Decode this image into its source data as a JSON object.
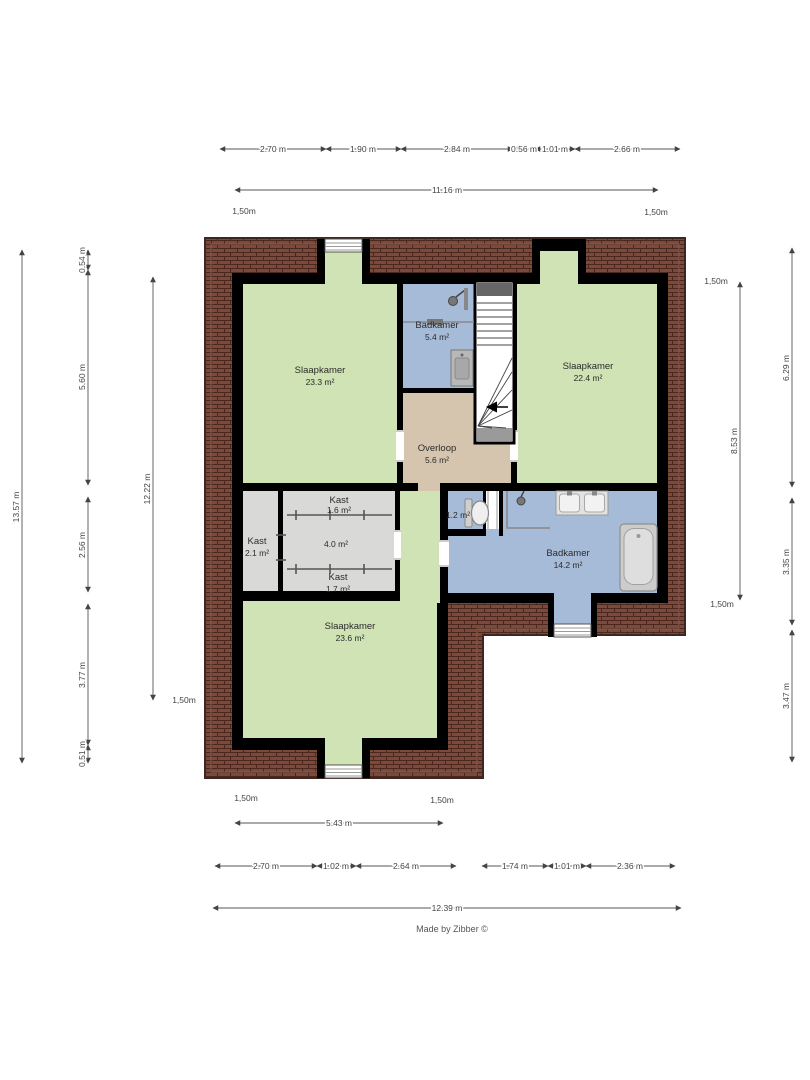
{
  "footer": {
    "credit": "Made by Zibber ©"
  },
  "rooms": {
    "bedroom_top_left": {
      "name": "Slaapkamer",
      "area": "23.3 m²"
    },
    "bathroom_top": {
      "name": "Badkamer",
      "area": "5.4 m²"
    },
    "bedroom_top_right": {
      "name": "Slaapkamer",
      "area": "22.4 m²"
    },
    "landing": {
      "name": "Overloop",
      "area": "5.6 m²"
    },
    "closet_left": {
      "name": "Kast",
      "area": "2.1 m²"
    },
    "closet_top": {
      "name": "Kast",
      "area": "1.6 m²"
    },
    "closet_mid": {
      "area": "4.0 m²"
    },
    "closet_bottom": {
      "name": "Kast",
      "area": "1.7 m²"
    },
    "toilet": {
      "area": "1.2 m²"
    },
    "bathroom_main": {
      "name": "Badkamer",
      "area": "14.2 m²"
    },
    "bedroom_bottom": {
      "name": "Slaapkamer",
      "area": "23.6 m²"
    }
  },
  "dimensions": {
    "marker": "1,50m",
    "top": {
      "segments": [
        "2.70 m",
        "1.90 m",
        "2.84 m",
        "0.56 m",
        "1.01 m",
        "2.66 m"
      ],
      "total": "11.16 m"
    },
    "bottom": {
      "segments": [
        "2.70 m",
        "1.02 m",
        "2.64 m",
        "1.74 m",
        "1.01 m",
        "2.36 m"
      ],
      "total": "12.39 m",
      "partial": "5.43 m"
    },
    "left": {
      "outer": "13.57 m",
      "segments": [
        "0.54 m",
        "5.60 m",
        "2.56 m",
        "3.77 m",
        "0.51 m"
      ],
      "inner": "12.22 m"
    },
    "right": {
      "inner": "8.53 m",
      "segments": [
        "6.29 m",
        "3.35 m",
        "3.47 m"
      ]
    }
  },
  "colors": {
    "bedroom": "#cfe3b4",
    "bathroom": "#a6bbd8",
    "landing": "#d6c5ae",
    "closet": "#d9d9d7",
    "wall": "#000000",
    "brick": "#7b4a3a",
    "brick_line": "#4a2820"
  }
}
